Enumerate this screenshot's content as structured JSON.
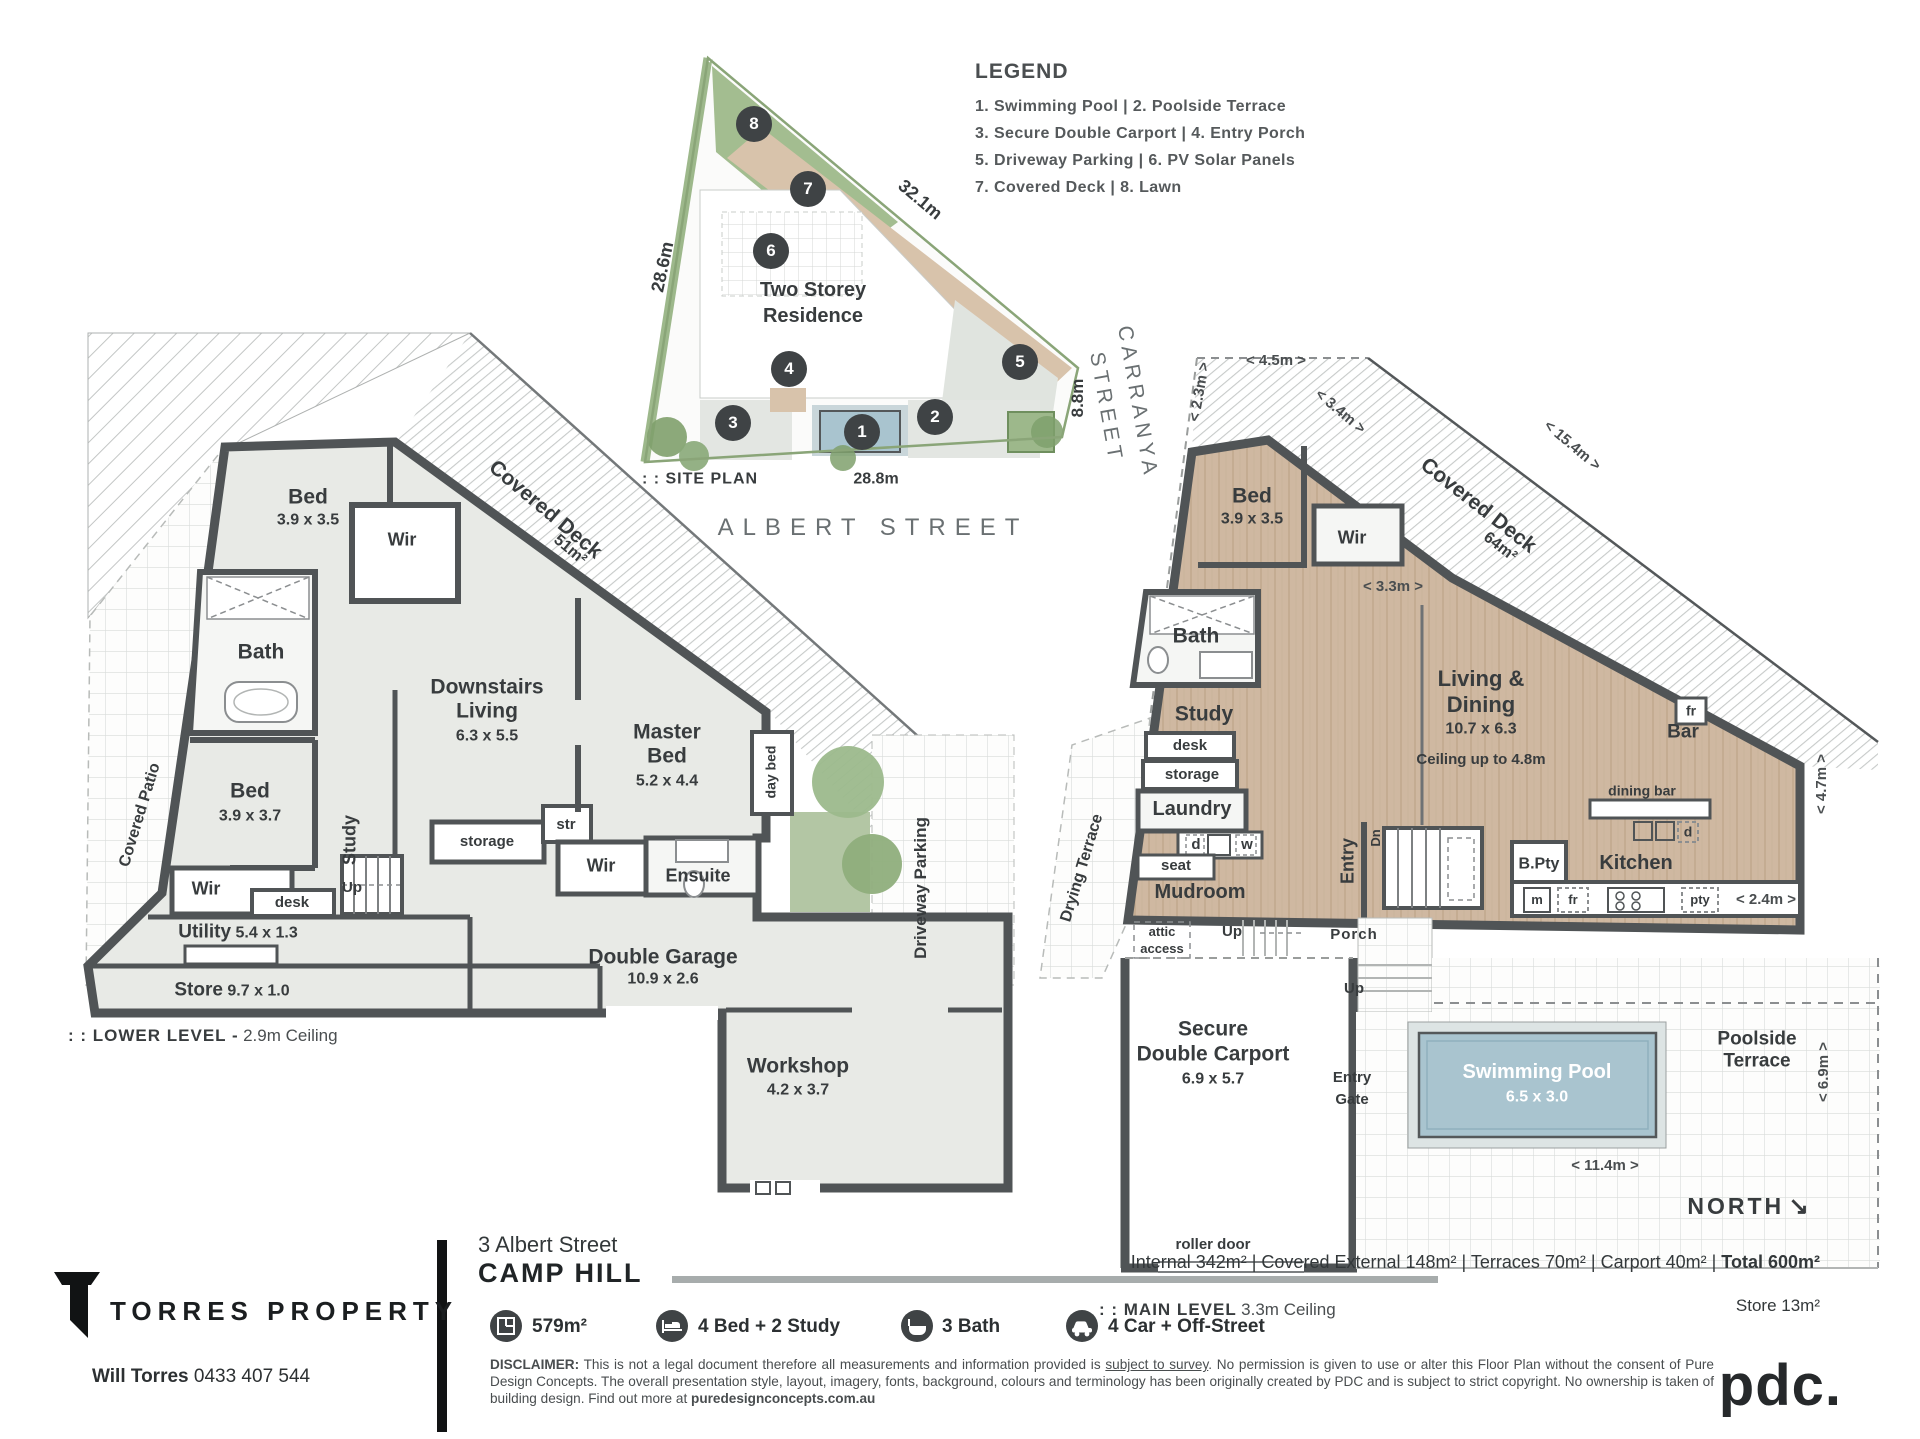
{
  "colors": {
    "wall": "#505456",
    "room_gray": "#e8eae6",
    "wood": "#cfb8a1",
    "pool_blue": "#a9c4cf",
    "lawn_green": "#a3bd90",
    "marker_dark": "#3f4345"
  },
  "legend": {
    "title": "LEGEND",
    "lines": [
      "1. Swimming Pool  |  2. Poolside Terrace",
      "3. Secure Double Carport  |  4. Entry Porch",
      "5. Driveway Parking  |  6. PV Solar Panels",
      "7. Covered Deck  |  8. Lawn"
    ]
  },
  "site": {
    "plan_label": ": : SITE PLAN",
    "residence_line1": "Two Storey",
    "residence_line2": "Residence",
    "dim_hyp": "32.1m",
    "dim_left": "28.6m",
    "dim_bottom": "28.8m",
    "dim_right": "8.8m",
    "street_bottom": "ALBERT STREET",
    "street_right_line1": "CARRANYA",
    "street_right_line2": "STREET",
    "markers": [
      "1",
      "2",
      "3",
      "4",
      "5",
      "6",
      "7",
      "8"
    ]
  },
  "lower": {
    "title": ": : LOWER LEVEL -",
    "ceiling": "2.9m Ceiling",
    "bed1": {
      "name": "Bed",
      "dim": "3.9 x 3.5"
    },
    "wir1": "Wir",
    "deck": {
      "name": "Covered Deck",
      "area": "51m²"
    },
    "bath": "Bath",
    "bed2": {
      "name": "Bed",
      "dim": "3.9 x 3.7"
    },
    "patio": "Covered Patio",
    "wir2": "Wir",
    "study": "Study",
    "desk": "desk",
    "storage": "storage",
    "up": "Up",
    "str": "str",
    "living": {
      "l1": "Downstairs",
      "l2": "Living",
      "dim": "6.3 x 5.5"
    },
    "master": {
      "l1": "Master",
      "l2": "Bed",
      "dim": "5.2 x 4.4"
    },
    "daybed": "day bed",
    "wir3": "Wir",
    "ensuite": "Ensuite",
    "utility": {
      "name": "Utility",
      "dim": "5.4 x 1.3"
    },
    "store": {
      "name": "Store",
      "dim": "9.7 x 1.0"
    },
    "garage": {
      "name": "Double Garage",
      "dim": "10.9 x 2.6"
    },
    "workshop": {
      "name": "Workshop",
      "dim": "4.2 x 3.7"
    },
    "driveway": "Driveway Parking"
  },
  "main": {
    "title": ": : MAIN LEVEL",
    "ceiling": "3.3m Ceiling",
    "bed": {
      "name": "Bed",
      "dim": "3.9 x 3.5"
    },
    "wir": "Wir",
    "deck": {
      "name": "Covered Deck",
      "area": "64m²"
    },
    "dims": {
      "d45": "< 4.5m >",
      "d23": "< 2.3m >",
      "d34": "< 3.4m >",
      "d154": "< 15.4m >",
      "d33": "< 3.3m >",
      "d47": "< 4.7m >",
      "d24": "< 2.4m >",
      "d69": "< 6.9m >",
      "d114": "< 11.4m >"
    },
    "bath": "Bath",
    "study": "Study",
    "desk": "desk",
    "storage": "storage",
    "laundry": "Laundry",
    "d": "d",
    "w": "w",
    "seat": "seat",
    "mudroom": "Mudroom",
    "drying": "Drying Terrace",
    "attic1": "attic",
    "attic2": "access",
    "up1": "Up",
    "entry": "Entry",
    "dn": "Dn",
    "porch": "Porch",
    "up2": "Up",
    "living": {
      "l1": "Living &",
      "l2": "Dining",
      "dim": "10.7 x 6.3",
      "note": "Ceiling up to 4.8m"
    },
    "fr1": "fr",
    "bar": "Bar",
    "dining_bar": "dining bar",
    "d2": "d",
    "bpty": "B.Pty",
    "kitchen": "Kitchen",
    "m": "m",
    "fr2": "fr",
    "pty": "pty",
    "carport": {
      "l1": "Secure",
      "l2": "Double Carport",
      "dim": "6.9 x 5.7"
    },
    "entry_gate_l1": "Entry",
    "entry_gate_l2": "Gate",
    "pool": {
      "name": "Swimming Pool",
      "dim": "6.5 x 3.0"
    },
    "poolside_l1": "Poolside",
    "poolside_l2": "Terrace",
    "roller": "roller door",
    "north": "NORTH",
    "north_arrow": "↘"
  },
  "footer": {
    "address_line1": "3 Albert Street",
    "address_line2": "CAMP HILL",
    "areas_text": "Internal 342m²  |  Covered External 148m²  |  Terraces 70m²  |  Carport 40m²  |  ",
    "areas_total": "Total 600m²",
    "store_note": "Store 13m²",
    "stats": [
      {
        "icon": "floorplan-icon",
        "label": "579m²"
      },
      {
        "icon": "bed-icon",
        "label": "4 Bed + 2 Study"
      },
      {
        "icon": "bath-icon",
        "label": "3 Bath"
      },
      {
        "icon": "car-icon",
        "label": "4 Car + Off-Street"
      }
    ],
    "disclaimer_label": "DISCLAIMER:",
    "disclaimer_p1": " This is not a legal document therefore all measurements and information provided is ",
    "disclaimer_underline": "subject to survey",
    "disclaimer_p2": ". No permission is given to use or alter this Floor Plan without the consent of Pure Design Concepts. The overall presentation style, layout, imagery, fonts, background, colours and terminology has been originally created by PDC and is subject to strict copyright. No ownership is taken of building design. Find out more at ",
    "disclaimer_site": "puredesignconcepts.com.au",
    "brand": "TORRES PROPERTY",
    "agent_name": "Will Torres",
    "agent_phone": " 0433 407 544",
    "pdc": "pdc."
  }
}
